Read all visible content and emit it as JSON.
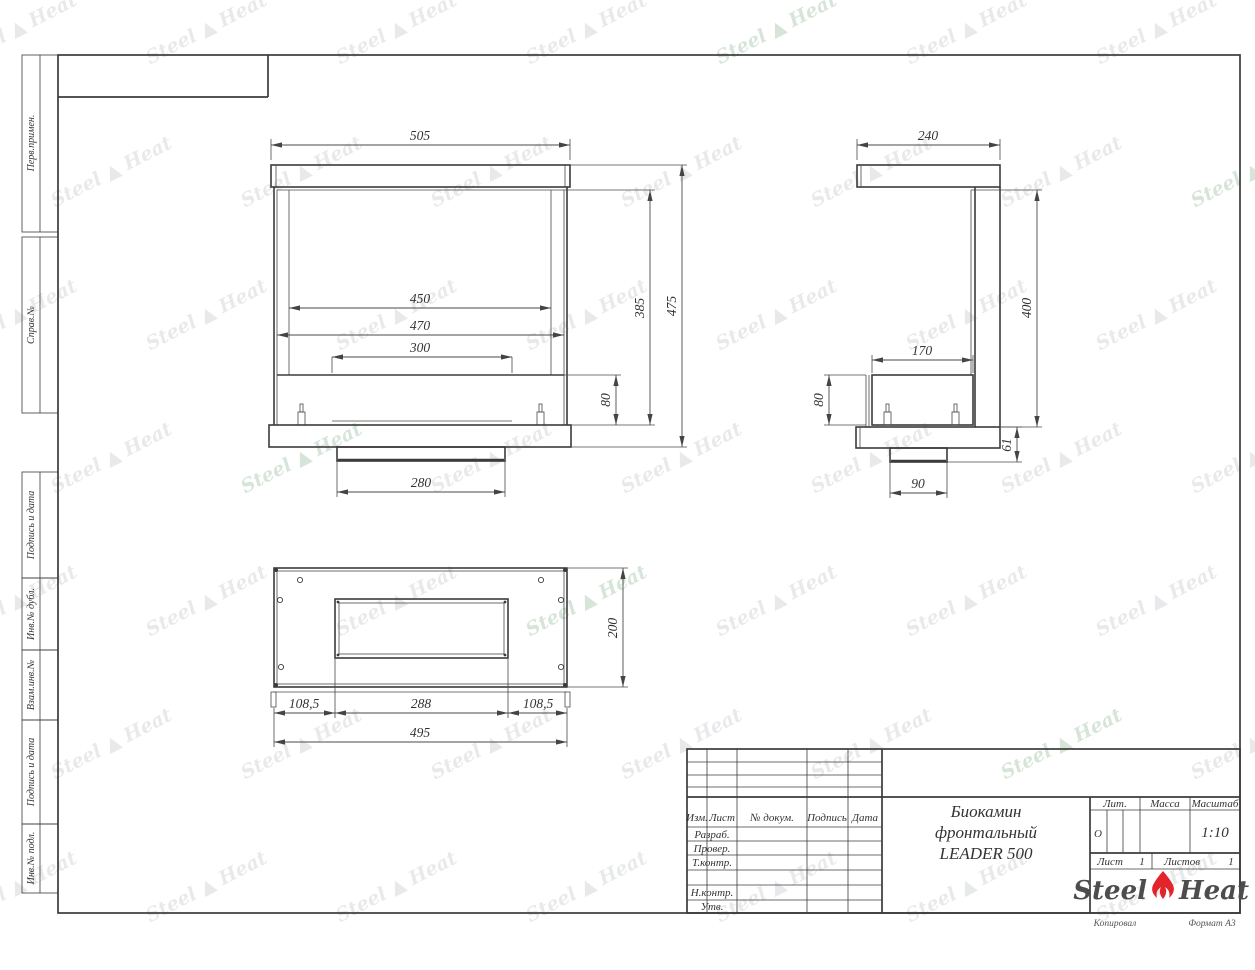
{
  "page": {
    "copied": "Копировал",
    "format_note": "Формат А3"
  },
  "title": {
    "line1": "Биокамин",
    "line2": "фронтальный",
    "line3": "LEADER 500"
  },
  "title_block": {
    "header": {
      "izm": "Изм.",
      "list": "Лист",
      "doc": "№ докум.",
      "sign": "Подпись",
      "date": "Дата"
    },
    "rows": {
      "developed": "Разраб.",
      "checked": "Провер.",
      "tcontrol": "Т.контр.",
      "ncontrol": "Н.контр.",
      "approved": "Утв."
    },
    "lit_label": "Лит.",
    "mass_label": "Масса",
    "scale_label": "Масштаб",
    "lit_value": "О",
    "scale_value": "1:10",
    "sheet_label": "Лист",
    "sheet_value": "1",
    "sheets_label": "Листов",
    "sheets_value": "1"
  },
  "side_stamps": {
    "perv": "Перв.примен.",
    "sprav": "Справ.№",
    "podp1": "Подпись и дата",
    "inv_dubl": "Инв.№ дубл.",
    "vzam": "Взам.инв.№",
    "podp2": "Подпись и дата",
    "inv_podl": "Инв.№ подл."
  },
  "logo": {
    "part1": "Steel",
    "part2": "Heat",
    "flame_color": "#e3242b"
  },
  "watermark": {
    "part1": "Steel",
    "part2": "Heat",
    "flame_glyph": "▲",
    "color": "#969BA2",
    "accent_color": "#76AA7E"
  },
  "dims": {
    "front": {
      "overall_width": "505",
      "opening_width": "450",
      "frame_width": "470",
      "slot_width": "300",
      "inner_height": "385",
      "overall_height": "475",
      "burner_height": "80",
      "tray_width": "280"
    },
    "side": {
      "depth": "240",
      "body_height": "400",
      "burner_depth": "170",
      "burner_height": "80",
      "base_height": "61",
      "tray_depth": "90"
    },
    "bottom": {
      "depth": "200",
      "left_offset": "108,5",
      "slot_length": "288",
      "right_offset": "108,5",
      "overall_length": "495"
    }
  }
}
